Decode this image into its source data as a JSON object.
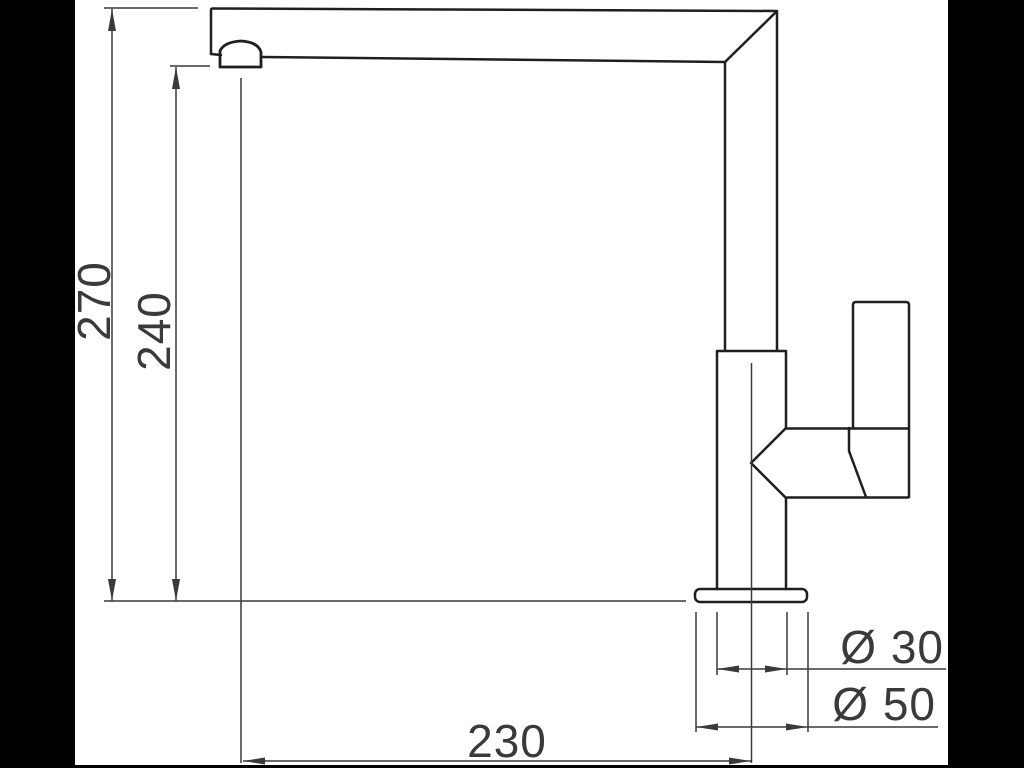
{
  "drawing": {
    "colors": {
      "frame": "#000000",
      "paper": "#ffffff",
      "outline": "#1f1f1f",
      "dimension": "#3a3a3a"
    },
    "dimensions": {
      "overall_height": "270",
      "spout_height": "240",
      "spout_reach": "230",
      "body_diameter": "Ø 30",
      "base_diameter": "Ø 50"
    }
  }
}
